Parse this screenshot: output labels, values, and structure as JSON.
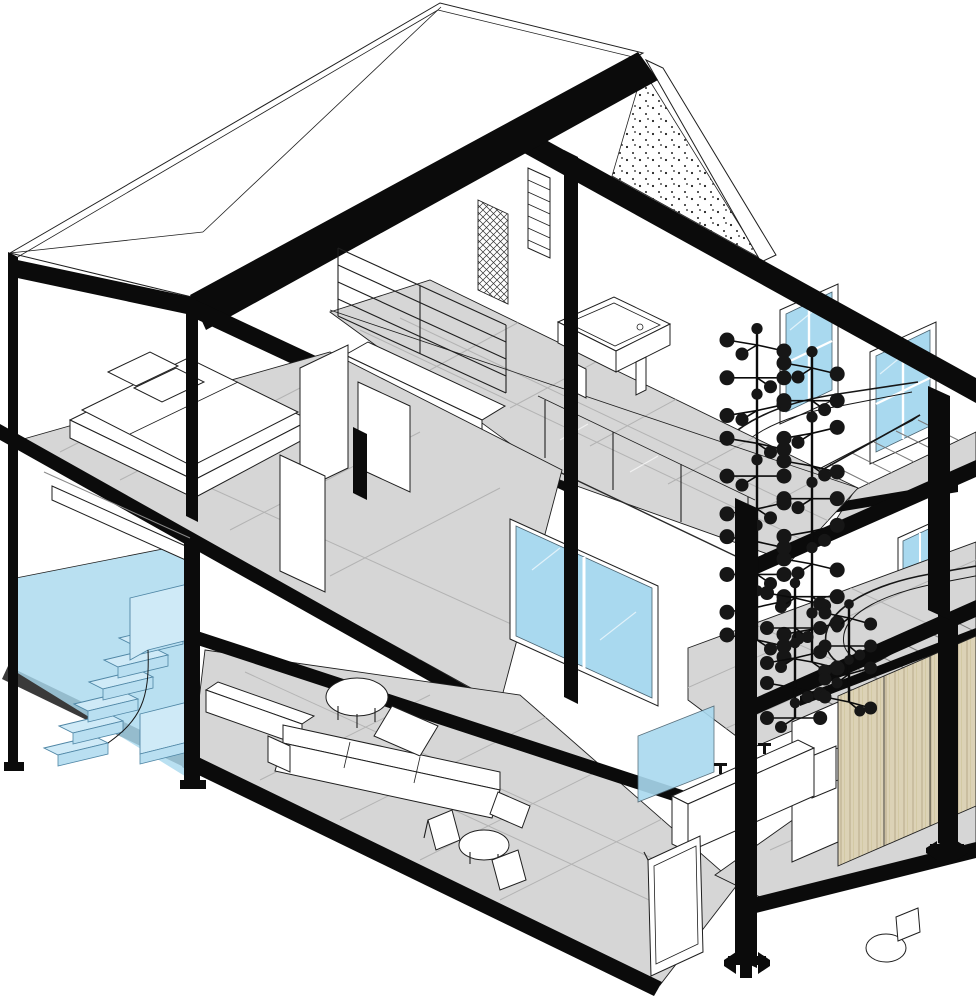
{
  "meta": {
    "title": "axonometric-cutaway-house-section",
    "description": "BIM-style 3D sectional axonometric of a three-level steel-frame house, front facade cut away",
    "visible_text": []
  },
  "palette": {
    "ink": "#0b0b0b",
    "outline": "#1f1f1f",
    "floor": "#d6d6d6",
    "tile": "#b3b3b3",
    "glass": "#a9d9ef",
    "glass-light": "#c6e7f6",
    "zone": "#a9d9ee",
    "step": "#cfeaf7",
    "step-edge": "#4f86a5",
    "wood": "#dcd2b6",
    "wood-line": "#b7ab89",
    "paper": "#ffffff"
  },
  "scene": {
    "levels": [
      "ground-floor",
      "second-floor",
      "attic"
    ],
    "highlight": "entry-stair-volume-highlighted-blue",
    "structure": "black steel columns, beams and roof fascias",
    "gable": "stippled concrete gable wall",
    "windows": [
      "attic-gable-window-1",
      "attic-gable-window-2",
      "second-floor-end-window",
      "ground-floor-end-window",
      "living-room-sliding-window"
    ],
    "furniture": [
      "double-bed",
      "l-shaped-sofa",
      "round-coffee-table",
      "armchair-pair-with-table",
      "billiard-table",
      "bookshelf",
      "bathroom-vanity",
      "toilet",
      "wardrobe",
      "sideboard"
    ],
    "stairs": [
      "blue-entry-stair",
      "curved-stair-to-second-floor",
      "curved-stair-to-attic"
    ]
  },
  "chandeliers": [
    {
      "group": "upper",
      "x": 757,
      "yTop": 345,
      "yBot": 640,
      "levels": 10,
      "r": 7.5,
      "spread": 30
    },
    {
      "group": "upper",
      "x": 812,
      "yTop": 368,
      "yBot": 662,
      "levels": 10,
      "r": 7.5,
      "spread": 28
    },
    {
      "group": "lower",
      "x": 795,
      "yTop": 598,
      "yBot": 718,
      "levels": 5,
      "r": 7,
      "spread": 28
    },
    {
      "group": "lower",
      "x": 849,
      "yTop": 618,
      "yBot": 702,
      "levels": 4,
      "r": 6.5,
      "spread": 24
    }
  ],
  "stairs_lines": {
    "upper": {
      "x0": 742,
      "y0": 508,
      "dx": 22,
      "dy": -11,
      "len": 40,
      "n": 9
    },
    "lower": {
      "x0": 800,
      "y0": 688,
      "dx": 24,
      "dy": -12,
      "len": 36,
      "n": 7
    }
  }
}
